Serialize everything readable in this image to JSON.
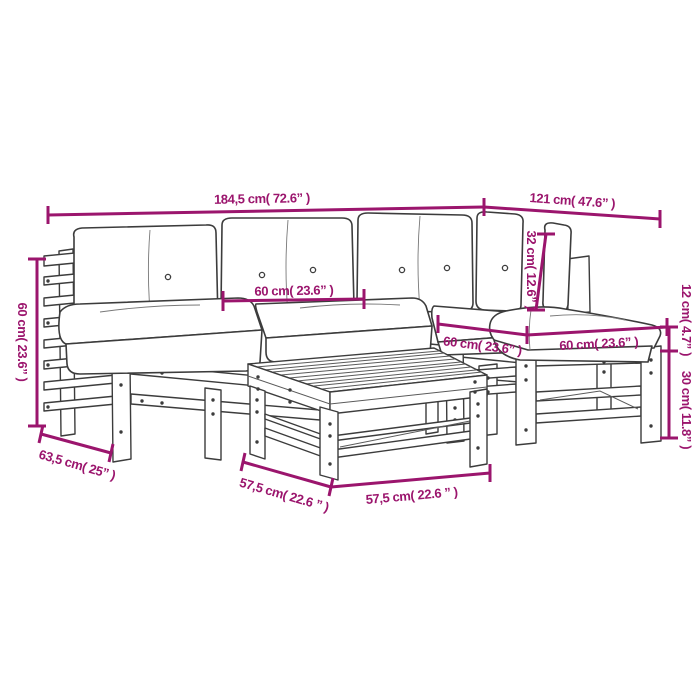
{
  "diagram": {
    "kind": "furniture dimension line drawing",
    "subject": "5-piece garden lounge set with cushions, table and footstool"
  },
  "colors": {
    "dimension_accent": "#9B156D",
    "drawing_line": "#3C3C3C",
    "background": "#FFFFFF"
  },
  "dimensions": {
    "total_width": "184,5 cm( 72.6” )",
    "right_depth": "121 cm( 47.6” )",
    "backrest_height": "32 cm( 12.6” )",
    "arm_height": "60 cm( 23.6” )",
    "arm_depth": "63,5 cm( 25” )",
    "middle_seat_width": "60 cm( 23.6” )",
    "corner_seat_width": "60 cm( 23.6” )",
    "ottoman_width": "60 cm( 23.6” )",
    "table_depth": "57,5 cm( 22.6 ” )",
    "table_width": "57,5 cm( 22.6 ” )",
    "cushion_height": "12 cm( 4.7” )",
    "frame_height": "30 cm( 11.8” )"
  }
}
